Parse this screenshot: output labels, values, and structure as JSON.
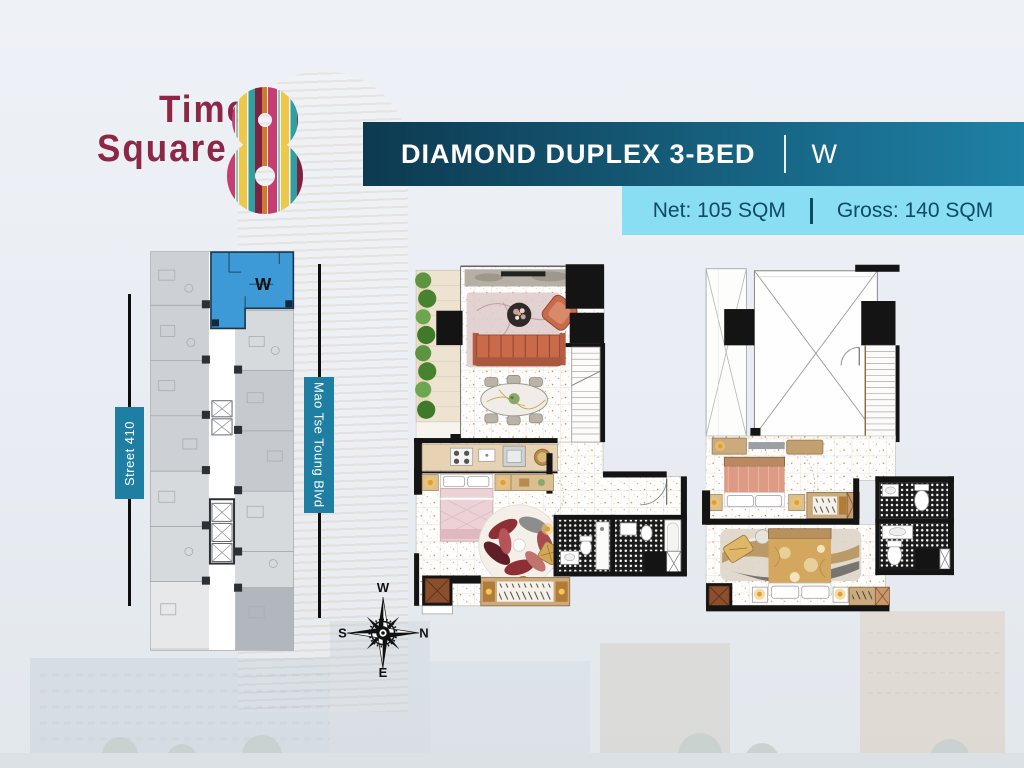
{
  "logo": {
    "word1": "Time",
    "word2": "Square",
    "numeral": "8"
  },
  "header": {
    "title": "DIAMOND DUPLEX 3-BED",
    "unit": "W"
  },
  "area_banner": {
    "net": "Net: 105 SQM",
    "gross": "Gross: 140 SQM"
  },
  "key_plan": {
    "unit_label": "W",
    "left_road": "Street 410",
    "right_road": "Mao Tse Toung Blvd"
  },
  "compass": {
    "top": "W",
    "right": "N",
    "left": "S",
    "bottom": "E"
  },
  "plans": {
    "upper": {
      "down_label": "DOWN"
    }
  },
  "colors": {
    "header-grad-start": "#0d3a50",
    "header-grad-end": "#1e81a6",
    "subbanner-bg": "#8adef4",
    "subbanner-text": "#0d4b63",
    "road-label-bg": "#1f7fa3",
    "highlight-blue": "#3d9ad6",
    "logo-maroon": "#8c2746",
    "sofa-terracotta": "#c96a4a"
  }
}
